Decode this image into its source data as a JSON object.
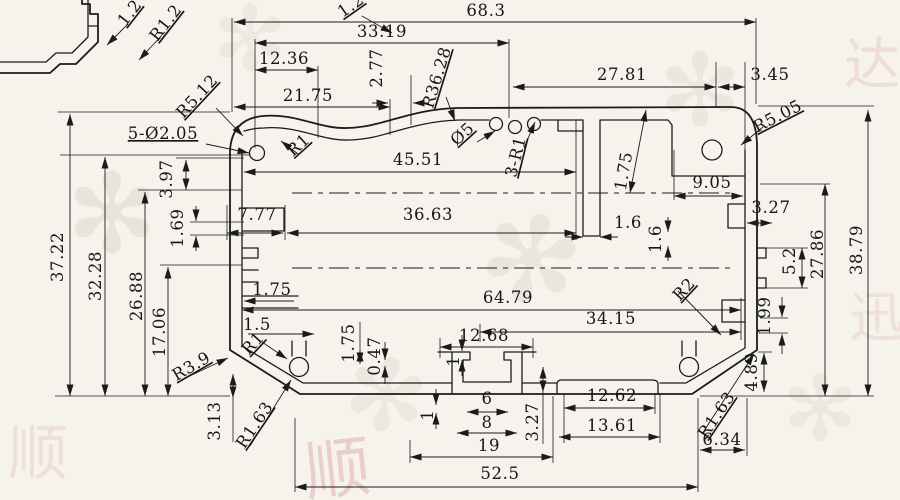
{
  "drawing": {
    "units_note": "",
    "colors": {
      "background": "#f6f3ec",
      "line": "#1b1b1b",
      "watermark_pink": "#cc7a88",
      "watermark_gray": "#d5cfc2"
    }
  },
  "dimensions": [
    {
      "t": "1.2",
      "x": 134,
      "y": 16,
      "r": -52,
      "u": 1
    },
    {
      "t": "R1.2",
      "x": 170,
      "y": 26,
      "r": -52,
      "u": 1
    },
    {
      "t": "1.2",
      "x": 354,
      "y": 10,
      "r": -35,
      "u": 1
    },
    {
      "t": "68.3",
      "x": 486,
      "y": 16
    },
    {
      "t": "33.19",
      "x": 382,
      "y": 37
    },
    {
      "t": "12.36",
      "x": 284,
      "y": 64
    },
    {
      "t": "2.77",
      "x": 382,
      "y": 68,
      "r": -90
    },
    {
      "t": "R36.28",
      "x": 442,
      "y": 79,
      "r": -73,
      "u": 1
    },
    {
      "t": "27.81",
      "x": 622,
      "y": 80
    },
    {
      "t": "3.45",
      "x": 770,
      "y": 80
    },
    {
      "t": "21.75",
      "x": 308,
      "y": 101
    },
    {
      "t": "R5.12",
      "x": 201,
      "y": 100,
      "r": -47,
      "u": 1
    },
    {
      "t": "R5.05",
      "x": 780,
      "y": 121,
      "r": -27,
      "u": 1
    },
    {
      "t": "5-Ø2.05",
      "x": 163,
      "y": 139,
      "u": 1
    },
    {
      "t": "R1",
      "x": 302,
      "y": 149,
      "r": -42,
      "u": 1
    },
    {
      "t": "Ø5",
      "x": 466,
      "y": 138,
      "r": -42,
      "u": 1
    },
    {
      "t": "3-R1",
      "x": 521,
      "y": 158,
      "r": -76,
      "u": 1
    },
    {
      "t": "45.51",
      "x": 418,
      "y": 165
    },
    {
      "t": "1.75",
      "x": 629,
      "y": 172,
      "r": -80
    },
    {
      "t": "9.05",
      "x": 712,
      "y": 188
    },
    {
      "t": "3.97",
      "x": 172,
      "y": 179,
      "r": -90
    },
    {
      "t": "1.69",
      "x": 183,
      "y": 228,
      "r": -90
    },
    {
      "t": "7.77",
      "x": 257,
      "y": 220
    },
    {
      "t": "36.63",
      "x": 428,
      "y": 220
    },
    {
      "t": "1.6",
      "x": 628,
      "y": 228
    },
    {
      "t": "1.6",
      "x": 661,
      "y": 239,
      "r": -90
    },
    {
      "t": "3.27",
      "x": 771,
      "y": 213
    },
    {
      "t": "27.86",
      "x": 823,
      "y": 254,
      "r": -90
    },
    {
      "t": "38.79",
      "x": 862,
      "y": 250,
      "r": -90
    },
    {
      "t": "5.2",
      "x": 795,
      "y": 261,
      "r": -90
    },
    {
      "t": "37.22",
      "x": 63,
      "y": 257,
      "r": -90
    },
    {
      "t": "32.28",
      "x": 101,
      "y": 276,
      "r": -90
    },
    {
      "t": "26.88",
      "x": 142,
      "y": 296,
      "r": -90
    },
    {
      "t": "17.06",
      "x": 165,
      "y": 332,
      "r": -90
    },
    {
      "t": "1.75",
      "x": 272,
      "y": 295
    },
    {
      "t": "64.79",
      "x": 508,
      "y": 303
    },
    {
      "t": "R2",
      "x": 688,
      "y": 293,
      "r": -47,
      "u": 1
    },
    {
      "t": "34.15",
      "x": 611,
      "y": 324
    },
    {
      "t": "1.99",
      "x": 770,
      "y": 316,
      "r": -90
    },
    {
      "t": "1.5",
      "x": 257,
      "y": 330
    },
    {
      "t": "R1",
      "x": 257,
      "y": 347,
      "r": -47,
      "u": 1
    },
    {
      "t": "1.75",
      "x": 354,
      "y": 343,
      "r": -90
    },
    {
      "t": "0.47",
      "x": 380,
      "y": 356,
      "r": -90
    },
    {
      "t": "12.68",
      "x": 484,
      "y": 341
    },
    {
      "t": "1",
      "x": 459,
      "y": 361,
      "r": -90
    },
    {
      "t": "R3.9",
      "x": 194,
      "y": 371,
      "r": -30,
      "u": 1
    },
    {
      "t": "4.89",
      "x": 757,
      "y": 372,
      "r": -90
    },
    {
      "t": "1",
      "x": 433,
      "y": 415,
      "r": -90
    },
    {
      "t": "6",
      "x": 487,
      "y": 404
    },
    {
      "t": "12.62",
      "x": 612,
      "y": 401
    },
    {
      "t": "3.13",
      "x": 220,
      "y": 421,
      "r": -90
    },
    {
      "t": "R1.63",
      "x": 259,
      "y": 428,
      "r": -56,
      "u": 1
    },
    {
      "t": "3.27",
      "x": 538,
      "y": 422,
      "r": -90
    },
    {
      "t": "8",
      "x": 487,
      "y": 428
    },
    {
      "t": "13.61",
      "x": 612,
      "y": 431
    },
    {
      "t": "R1.63",
      "x": 721,
      "y": 418,
      "r": -56,
      "u": 1
    },
    {
      "t": "19",
      "x": 489,
      "y": 451
    },
    {
      "t": "6.34",
      "x": 722,
      "y": 445
    },
    {
      "t": "52.5",
      "x": 500,
      "y": 479
    }
  ],
  "watermarks": [
    {
      "glyph": "顺",
      "x": 340,
      "y": 492,
      "size": 66,
      "color": "#cc7a88",
      "opacity": 0.3,
      "rotate": -6
    },
    {
      "glyph": "顺",
      "x": 38,
      "y": 474,
      "size": 60,
      "color": "#cc7a88",
      "opacity": 0.16,
      "rotate": 0
    },
    {
      "glyph": "达",
      "x": 872,
      "y": 84,
      "size": 56,
      "color": "#cc7a88",
      "opacity": 0.18,
      "rotate": 0
    },
    {
      "glyph": "迅",
      "x": 876,
      "y": 336,
      "size": 54,
      "color": "#cc7a88",
      "opacity": 0.15,
      "rotate": 0
    },
    {
      "glyph": "✻",
      "x": 112,
      "y": 252,
      "size": 110,
      "color": "#d5cfc2",
      "opacity": 0.4,
      "rotate": 0
    },
    {
      "glyph": "✻",
      "x": 520,
      "y": 300,
      "size": 120,
      "color": "#d5cfc2",
      "opacity": 0.35,
      "rotate": 15
    },
    {
      "glyph": "✻",
      "x": 700,
      "y": 125,
      "size": 100,
      "color": "#d5cfc2",
      "opacity": 0.32,
      "rotate": 0
    },
    {
      "glyph": "✻",
      "x": 380,
      "y": 430,
      "size": 100,
      "color": "#d5cfc2",
      "opacity": 0.28,
      "rotate": 10
    },
    {
      "glyph": "✻",
      "x": 820,
      "y": 440,
      "size": 90,
      "color": "#d5cfc2",
      "opacity": 0.28,
      "rotate": 0
    },
    {
      "glyph": "✻",
      "x": 250,
      "y": 70,
      "size": 90,
      "color": "#d5cfc2",
      "opacity": 0.25,
      "rotate": 0
    }
  ]
}
